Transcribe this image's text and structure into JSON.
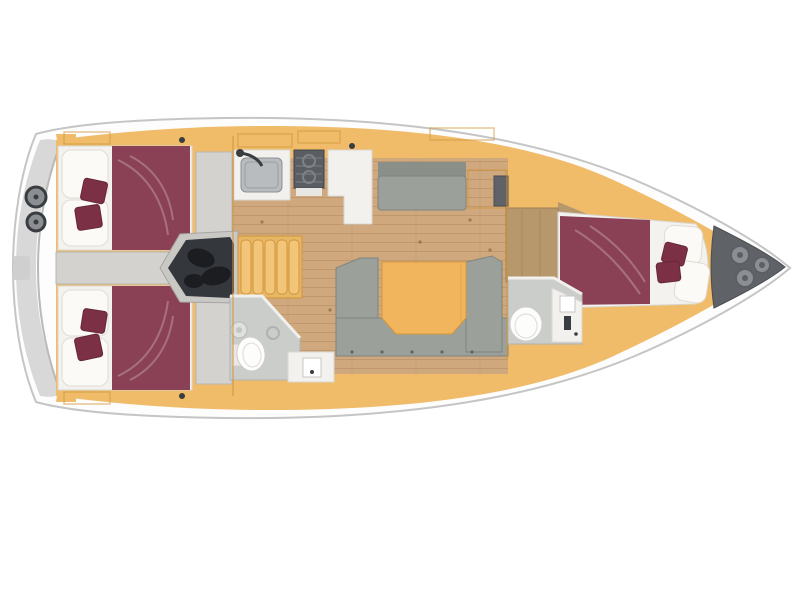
{
  "diagram": {
    "type": "floor-plan",
    "subject": "sailing yacht interior layout, top view, bow to the right",
    "areas": {
      "hull": "yacht hull and side deck",
      "stern_platform": "stern swim platform",
      "stern_hatches": "twin round stern hatches",
      "aft_cabin_top": "aft double cabin with burgundy berth (top)",
      "aft_cabin_bottom": "aft double cabin with burgundy berth (bottom)",
      "corridor": "aft centre corridor",
      "engine": "engine compartment",
      "companionway": "companionway steps",
      "galley": "galley with sink, stove and counter",
      "side_settee": "straight side settee",
      "salon": "salon with U-shaped settee and folding table",
      "aft_head": "aft bathroom with toilet, basin and vanity",
      "fwd_head": "forward bathroom with toilet and vanity",
      "fwd_wardrobe": "forward wardrobe bulkhead",
      "fwd_cabin": "forward double cabin with burgundy berth",
      "anchor_locker": "bow anchor locker"
    }
  },
  "colors": {
    "background": "#ffffff",
    "hull_stroke": "#c5c5c5",
    "deck": "#fdfdfd",
    "deck_line": "#dedede",
    "platform": "#d8d8d8",
    "platform_arc": "#b9b9b9",
    "cabinetry": "#f0bc6a",
    "cabinetry_line": "#d1953c",
    "floor": "#cfa87e",
    "floor_line": "#b28a5f",
    "corridor": "#d4d2ce",
    "corridor_line": "#b8b6b2",
    "bed": "#8a4156",
    "cushion": "#7c3046",
    "cushion_line": "#66273a",
    "linen": "#fbfaf7",
    "linen_line": "#e0dcd4",
    "frame": "#f4f2ee",
    "frame_line": "#d9d6d0",
    "settee": "#9ba19a",
    "settee_line": "#7f857e",
    "settee_back": "#8a9089",
    "table": "#f1b55e",
    "table_line": "#d4973a",
    "engine": "#34373c",
    "engine_dark": "#1b1d21",
    "walkway": "#c9c8c5",
    "walkway_line": "#a6a5a2",
    "appliance": "#5a5e63",
    "appliance_line": "#7e8287",
    "bath": "#cbcdca",
    "bath_line": "#b0b2af",
    "wall": "#f0f0ee",
    "porcelain": "#fdfdfb",
    "counter": "#f2f1ee",
    "counter_line": "#d8d6d2",
    "basin": "#b9bcbe",
    "basin_line": "#8f9295",
    "wood": "#b7976c",
    "wood_line": "#9c7e54",
    "locker": "#5f6266",
    "locker_circle": "#8b8e92",
    "locker_dot": "#5c5f63",
    "hardware": "#3a3d40",
    "dot": "#7a5c3c"
  }
}
